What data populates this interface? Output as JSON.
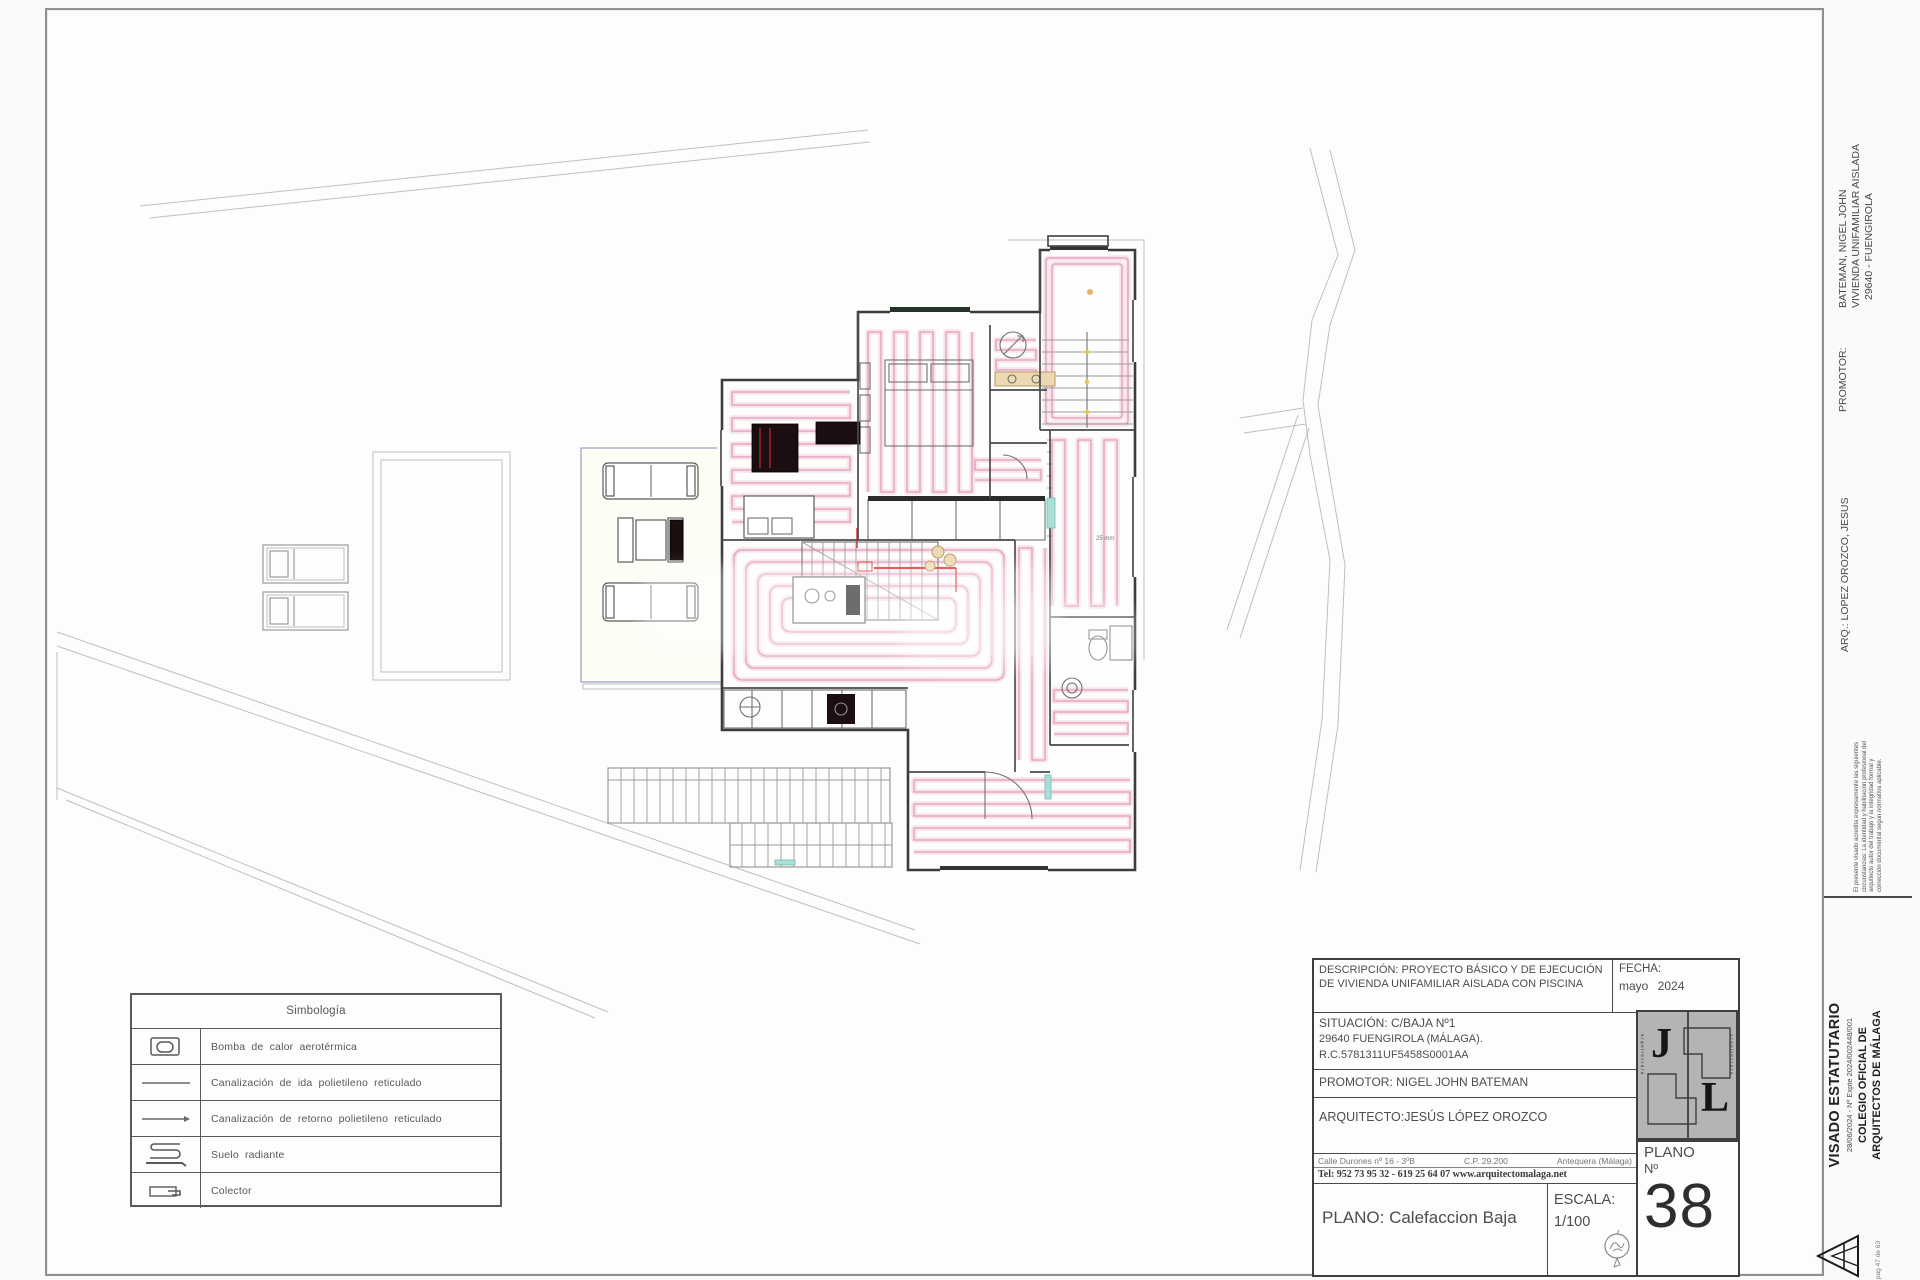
{
  "legend": {
    "title": "Simbología",
    "items": [
      {
        "icon": "heat-pump-icon",
        "label": "Bomba de calor aerotérmica"
      },
      {
        "icon": "supply-pipe-icon",
        "label": "Canalización de ida polietileno reticulado"
      },
      {
        "icon": "return-pipe-icon",
        "label": "Canalización de retorno polietileno reticulado"
      },
      {
        "icon": "radiant-floor-icon",
        "label": "Suelo radiante"
      },
      {
        "icon": "collector-icon",
        "label": "Colector"
      }
    ]
  },
  "title_block": {
    "descripcion": "DESCRIPCIÓN: PROYECTO BÁSICO Y DE EJECUCIÓN DE VIVIENDA UNIFAMILIAR AISLADA CON PISCINA",
    "fecha_label": "FECHA:",
    "fecha_value": "mayo 2024",
    "situacion_line1": "SITUACIÓN:  C/BAJA Nº1",
    "situacion_line2": "29640 FUENGIROLA (MÁLAGA).",
    "situacion_line3": "R.C.5781311UF5458S0001AA",
    "promotor": "PROMOTOR: NIGEL JOHN BATEMAN",
    "arquitecto": "ARQUITECTO:JESÚS LÓPEZ OROZCO",
    "address_left": "Calle Durones nº 16 - 3ºB",
    "address_mid": "C.P. 29.200",
    "address_right": "Antequera (Málaga)",
    "tel_line": "Tel: 952 73 95 32 - 619 25 64 07 www.arquitectomalaga.net",
    "plano_title": "PLANO: Calefaccion Baja",
    "escala_label": "ESCALA:",
    "escala_value": "1/100",
    "plano_label": "PLANO",
    "no_label": "Nº",
    "plano_number": "38",
    "logo_j": "J",
    "logo_l": "L",
    "logo_side_text": "arquitectura"
  },
  "side_column": {
    "promotor_label": "PROMOTOR:",
    "promotor_line1": "BATEMAN, NIGEL JOHN",
    "promotor_line2": "VIVIENDA UNIFAMILIAR AISLADA",
    "promotor_line3": "29640 - FUENGIROLA",
    "arq_line": "ARQ.: LOPEZ OROZCO, JESUS",
    "visado_note": "El presente visado acredita expresamente las siguientes circunstancias: La identidad y habilitación profesional del arquitecto autor del trabajo y la integridad formal y corrección documental según normativa aplicable.",
    "visado_title": "VISADO ESTATUTARIO",
    "visado_expediente": "28/06/2024 - Nº Expte 2024/002448/001",
    "colegio_line1": "COLEGIO OFICIAL DE",
    "colegio_line2": "ARQUITECTOS DE MÁLAGA",
    "page_ref": "pag 47 de 63"
  },
  "plan": {
    "annotation_pipe": "25 mm"
  },
  "colors": {
    "coil_pink": "#e09fbd",
    "accent_red": "#e03131",
    "wall": "#3c3c3c"
  }
}
